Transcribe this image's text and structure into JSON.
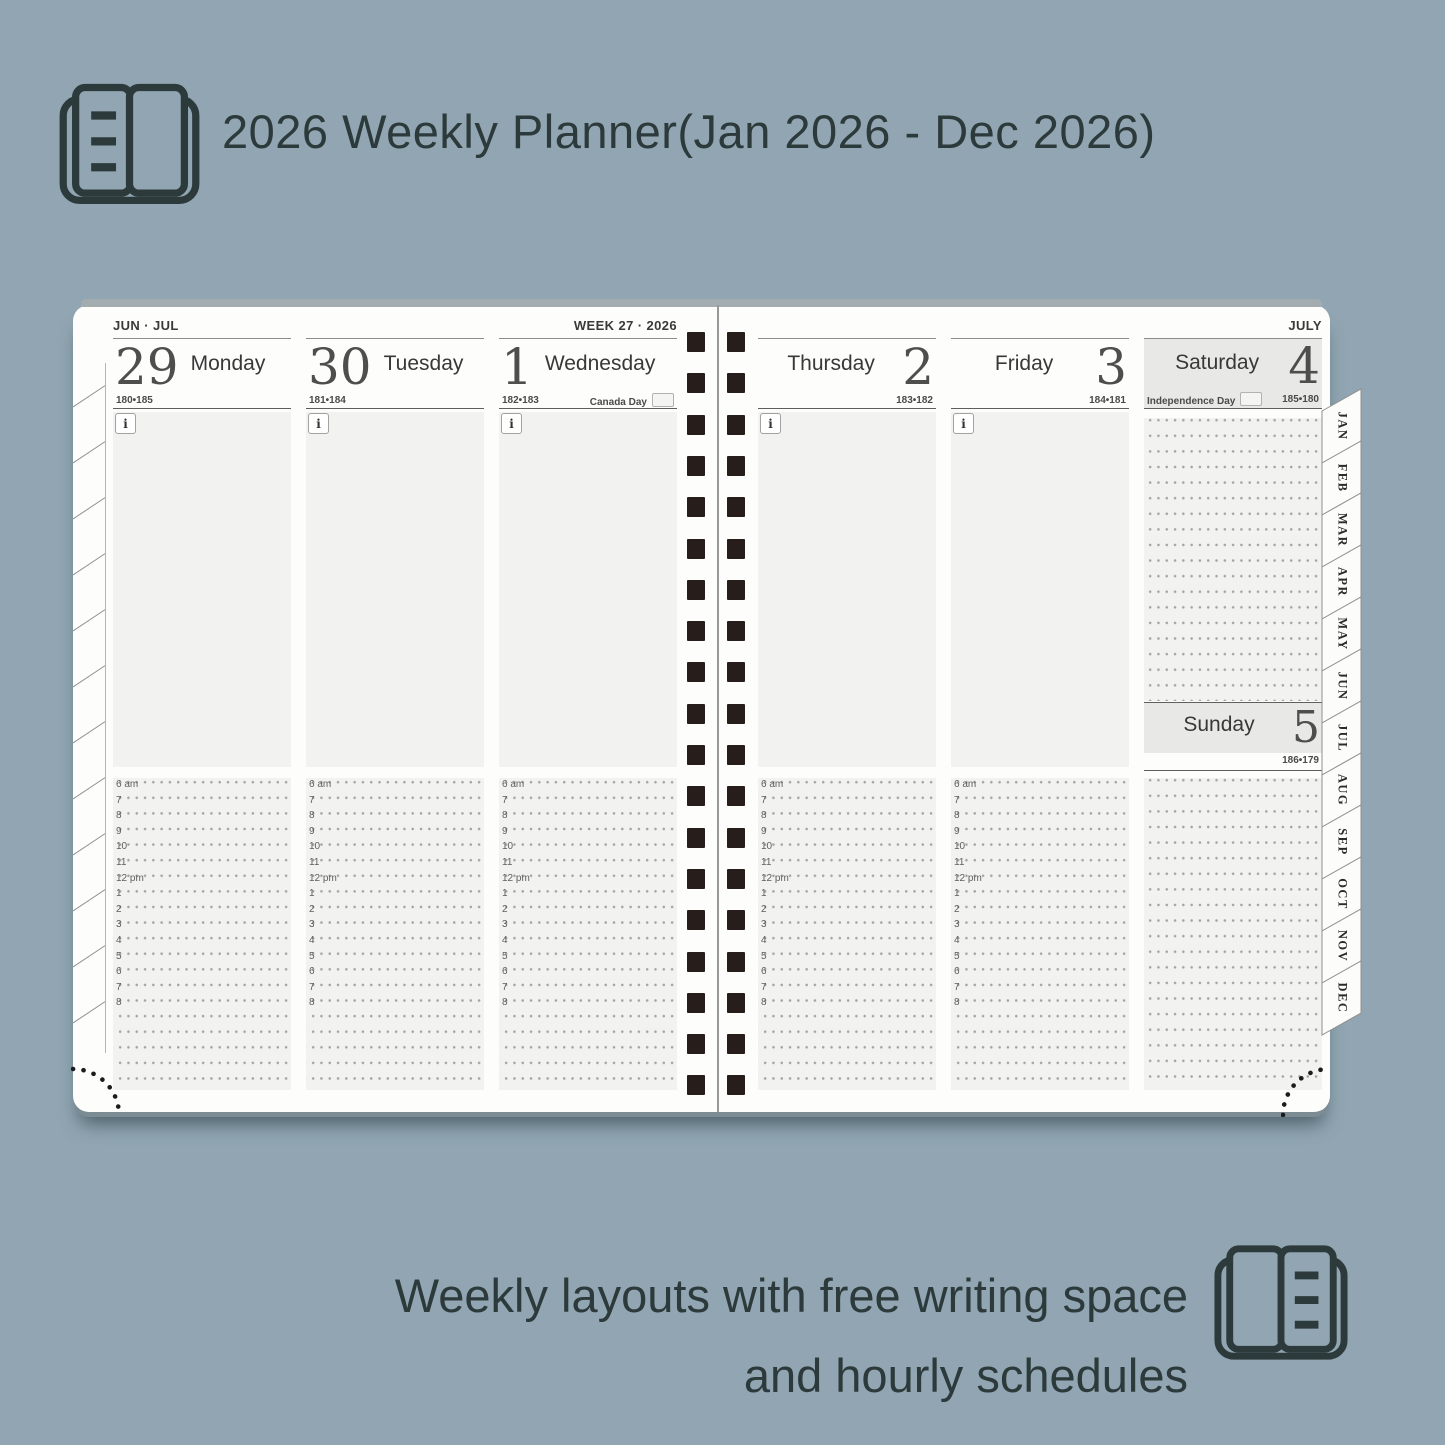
{
  "header": {
    "title": "2026 Weekly Planner(Jan 2026 - Dec 2026)",
    "icon": "open-planner-icon"
  },
  "footer": {
    "line1": "Weekly layouts with free writing space",
    "line2": "and hourly schedules",
    "icon": "open-planner-icon"
  },
  "planner": {
    "left_page": {
      "month_label": "JUN · JUL",
      "week_label": "WEEK 27 · 2026",
      "days": [
        {
          "date": "29",
          "name": "Monday",
          "day_of_year": "180•185"
        },
        {
          "date": "30",
          "name": "Tuesday",
          "day_of_year": "181•184"
        },
        {
          "date": "1",
          "name": "Wednesday",
          "day_of_year": "182•183",
          "holiday": "Canada Day"
        }
      ]
    },
    "right_page": {
      "month_label": "JULY",
      "days": [
        {
          "date": "2",
          "name": "Thursday",
          "day_of_year": "183•182"
        },
        {
          "date": "3",
          "name": "Friday",
          "day_of_year": "184•181"
        },
        {
          "date": "4",
          "name": "Saturday",
          "day_of_year": "185•180",
          "holiday": "Independence Day"
        }
      ],
      "sunday": {
        "date": "5",
        "name": "Sunday",
        "day_of_year": "186•179"
      }
    },
    "info_icon": "i",
    "hours": [
      "6 am",
      "7",
      "8",
      "9",
      "10",
      "11",
      "12 pm",
      "1",
      "2",
      "3",
      "4",
      "5",
      "6",
      "7",
      "8"
    ],
    "month_tabs": [
      "JAN",
      "FEB",
      "MAR",
      "APR",
      "MAY",
      "JUN",
      "JUL",
      "AUG",
      "SEP",
      "OCT",
      "NOV",
      "DEC"
    ]
  },
  "colors": {
    "background": "#91a6b2",
    "ink": "#2d3a3b",
    "page": "#fdfdfc",
    "panel": "#f2f2f0",
    "weekend_header": "#e8e8e6",
    "binding_hole": "#271e1b",
    "dots": "#a4a4a2"
  }
}
